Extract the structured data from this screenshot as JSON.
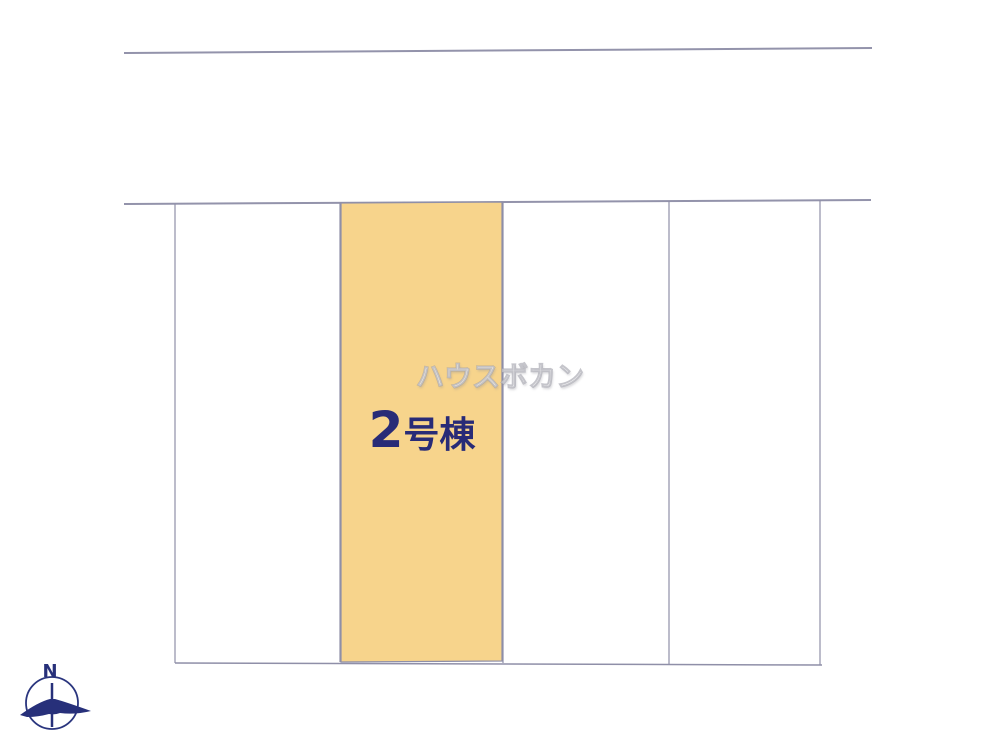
{
  "site_plan": {
    "title": "分譲区画図 (site plan)",
    "watermark": {
      "text": "ハウスボカン"
    },
    "highlighted_plot": {
      "number": "2",
      "suffix": "号棟",
      "full_label": "2号棟",
      "fill_color": "#f7d48c"
    },
    "plots": [
      {
        "id": "plot-1",
        "label": "",
        "highlighted": false
      },
      {
        "id": "plot-2",
        "label": "2号棟",
        "highlighted": true
      },
      {
        "id": "plot-3",
        "label": "",
        "highlighted": false
      },
      {
        "id": "plot-4",
        "label": "",
        "highlighted": false
      }
    ],
    "compass": {
      "north_label": "N"
    },
    "colors": {
      "boundary_line": "#9191aa",
      "plot_highlight": "#f7d48c",
      "label_text": "#282b77",
      "compass_navy": "#27307a",
      "watermark_gray": "#c9c9cf"
    }
  }
}
